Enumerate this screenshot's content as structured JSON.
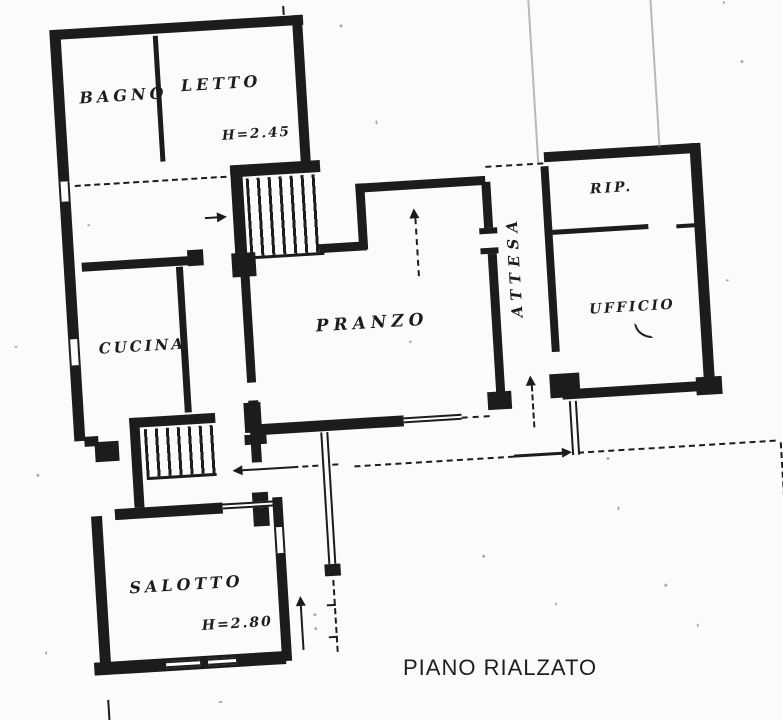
{
  "title": "PIANO RIALZATO",
  "rooms": {
    "bagno": {
      "label": "BAGNO"
    },
    "letto": {
      "label": "LETTO",
      "height": "H=2.45"
    },
    "cucina": {
      "label": "CUCINA"
    },
    "pranzo": {
      "label": "PRANZO"
    },
    "salotto": {
      "label": "SALOTTO",
      "height": "H=2.80"
    },
    "attesa": {
      "label": "ATTESA"
    },
    "rip": {
      "label": "RIP."
    },
    "ufficio": {
      "label": "UFFICIO"
    }
  },
  "colors": {
    "ink": "#1c1c1c",
    "paper": "#fbfbf9",
    "faint": "#97978f"
  }
}
